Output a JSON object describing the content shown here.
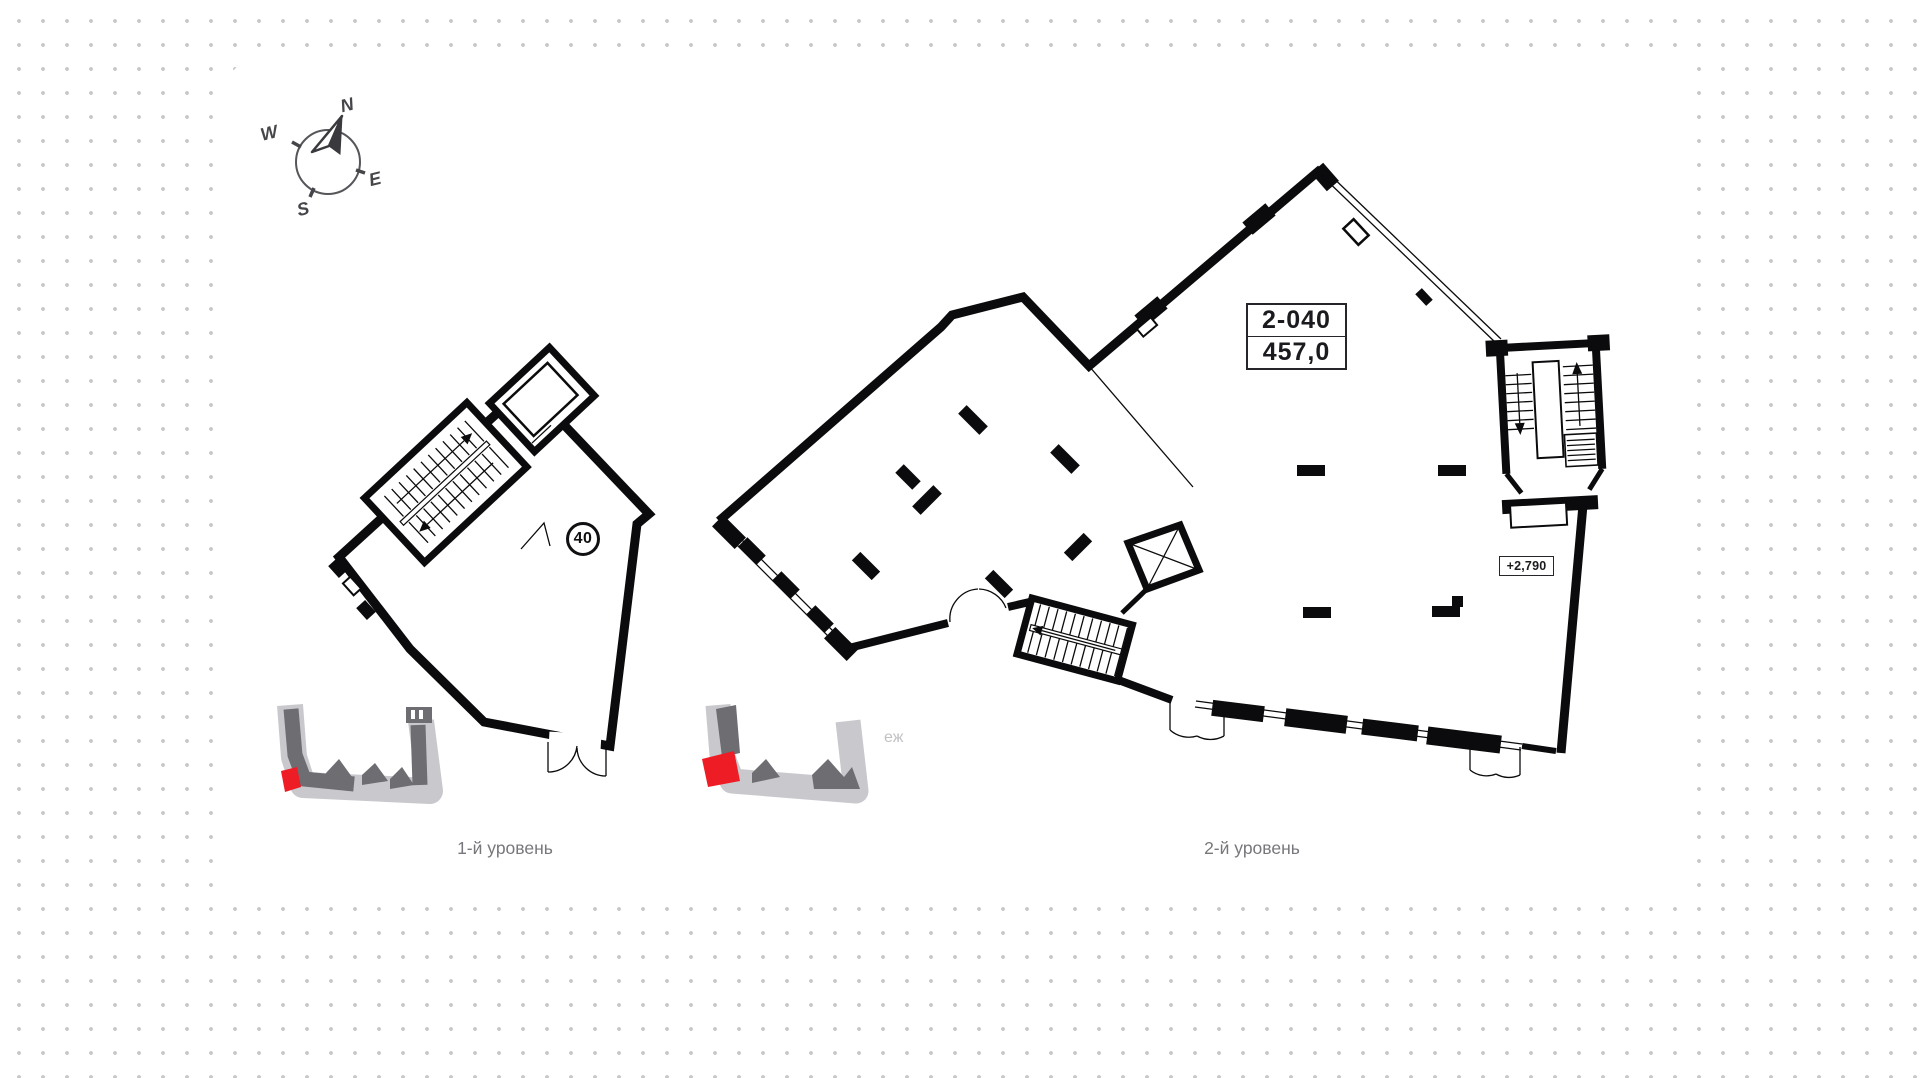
{
  "compass": {
    "north": "N",
    "east": "E",
    "south": "S",
    "west": "W"
  },
  "plans": {
    "level1": {
      "caption": "1-й уровень",
      "unit_number": "40"
    },
    "level2": {
      "caption": "2-й уровень",
      "unit_code": "2-040",
      "area_m2": "457,0",
      "elevation_mark": "+2,790"
    }
  },
  "watermark": {
    "fragment": "еж"
  },
  "theme": {
    "dot_color": "#c9c9cc",
    "card_color": "#ffffff",
    "wall_color": "#0b0b0d",
    "minimap_light": "#c9c9cd",
    "minimap_dark": "#6d6d72",
    "minimap_highlight": "#ee1c25",
    "caption_color": "#77777c"
  }
}
